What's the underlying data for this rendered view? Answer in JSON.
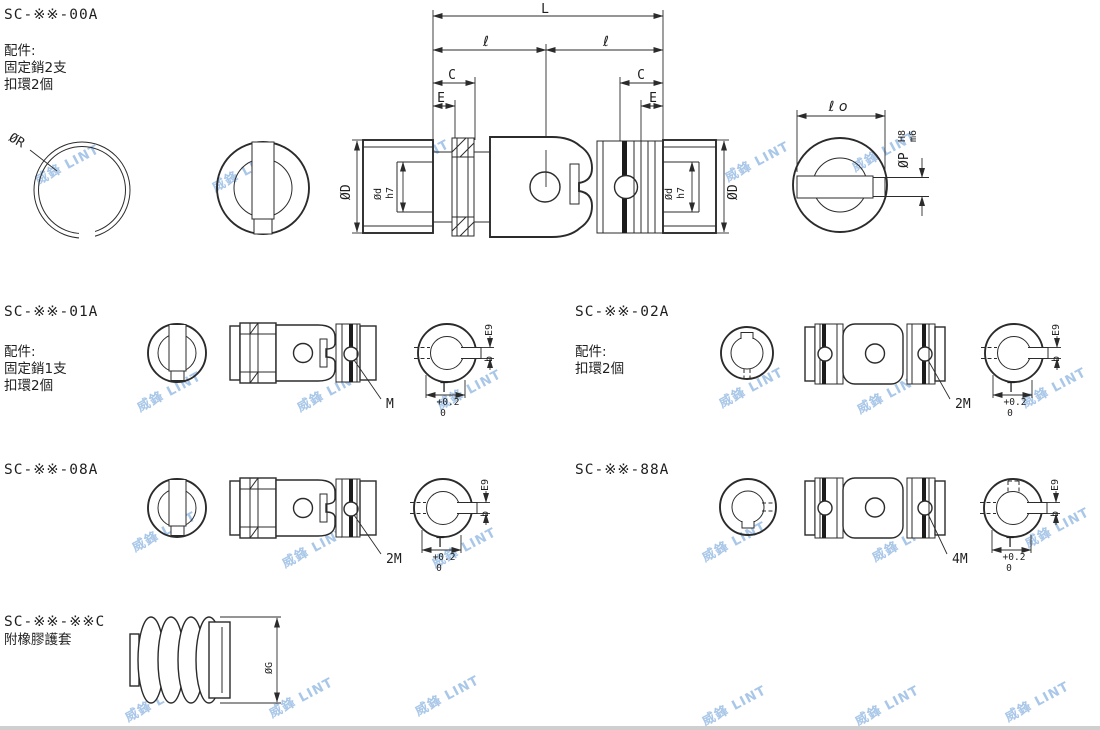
{
  "watermark": {
    "text": "威鋒 LINT",
    "color": "#a9c7e8"
  },
  "sections": {
    "s00a": {
      "code": "SC-※※-00A",
      "acc_title": "配件:",
      "acc_line1": "固定銷2支",
      "acc_line2": "扣環2個"
    },
    "s01a": {
      "code": "SC-※※-01A",
      "acc_title": "配件:",
      "acc_line1": "固定銷1支",
      "acc_line2": "扣環2個",
      "callout": "M"
    },
    "s02a": {
      "code": "SC-※※-02A",
      "acc_title": "配件:",
      "acc_line1": "扣環2個",
      "callout": "2M"
    },
    "s08a": {
      "code": "SC-※※-08A",
      "callout": "2M"
    },
    "s88a": {
      "code": "SC-※※-88A",
      "callout": "4M"
    },
    "sC": {
      "code": "SC-※※-※※C",
      "subtitle": "附橡膠護套"
    }
  },
  "dims": {
    "L": "L",
    "l": "ℓ",
    "lo": "ℓ o",
    "C": "C",
    "E": "E",
    "dia_R": "ØR",
    "dia_D": "ØD",
    "dia_d": "Ød",
    "fit_h7": "h7",
    "dia_P": "ØP",
    "fit_H8": "H8",
    "fit_m6": "m6",
    "fit_E9": "E9",
    "key_width": "b",
    "key_T": "T",
    "tol_plus": "+0.2",
    "tol_zero": "0",
    "dia_G": "ØG"
  }
}
